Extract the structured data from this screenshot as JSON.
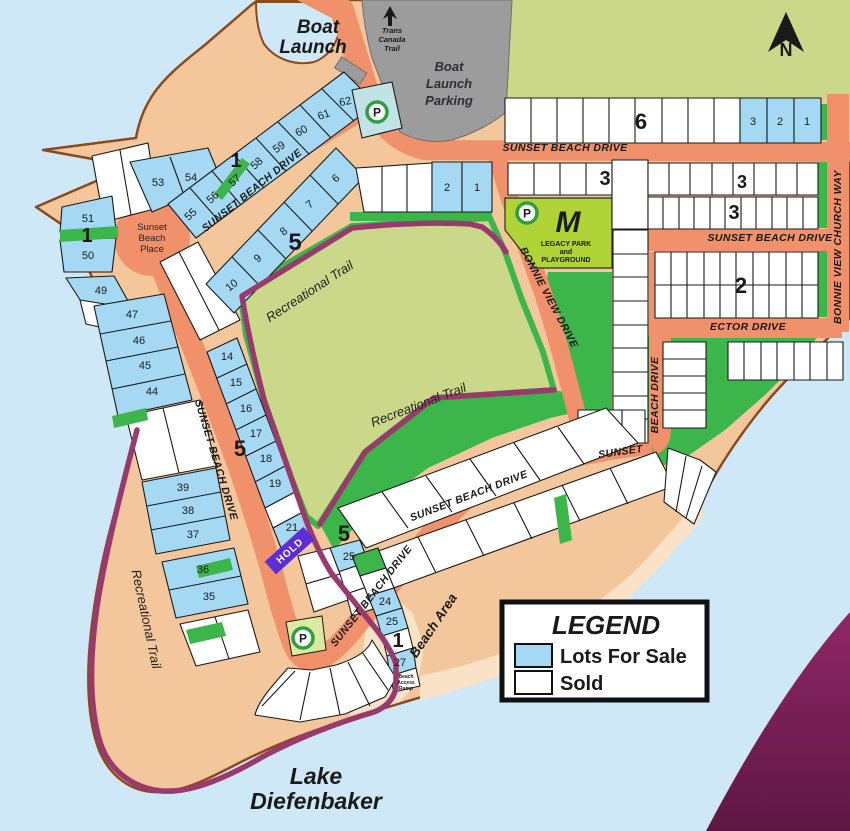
{
  "colors": {
    "water": "#cfe8f7",
    "land": "#f3c79b",
    "coast": "#8a4a1e",
    "beach": "#fae2c6",
    "olive": "#cbd88a",
    "green": "#3cb54a",
    "legacy": "#b0d437",
    "gray": "#9c9c9c",
    "road": "#f0916b",
    "forsale": "#a5d9f3",
    "sold": "#ffffff",
    "trail": "#993a6e",
    "deep_water_top": "#8f2766",
    "deep_water_bottom": "#5e1743",
    "hold_bg": "#5c2fd6"
  },
  "legend": {
    "title": "LEGEND",
    "items": [
      {
        "label": "Lots For Sale",
        "color": "#a5d9f3"
      },
      {
        "label": "Sold",
        "color": "#ffffff"
      }
    ]
  },
  "map": {
    "hold": "HOLD",
    "parking_letter": "P",
    "labels": [
      {
        "t": "SUNSET BEACH DRIVE",
        "x": 565,
        "y": 151,
        "r": 0,
        "c": "road"
      },
      {
        "t": "SUNSET BEACH DRIVE",
        "x": 770,
        "y": 241,
        "r": 0,
        "c": "road"
      },
      {
        "t": "ECTOR DRIVE",
        "x": 748,
        "y": 330,
        "r": 0,
        "c": "road"
      },
      {
        "t": "BONNIE VIEW CHURCH WAY",
        "x": 841,
        "y": 247,
        "r": -90,
        "c": "road"
      },
      {
        "t": "BONNIE VIEW DRIVE",
        "x": 546,
        "y": 299,
        "r": 62,
        "c": "road"
      },
      {
        "t": "SUNSET BEACH DRIVE",
        "x": 254,
        "y": 193,
        "r": -39,
        "c": "road"
      },
      {
        "t": "SUNSET BEACH DRIVE",
        "x": 213,
        "y": 461,
        "r": 73,
        "c": "road"
      },
      {
        "t": "SUNSET BEACH DRIVE",
        "x": 374,
        "y": 598,
        "r": -52,
        "c": "road"
      },
      {
        "t": "SUNSET BEACH DRIVE",
        "x": 470,
        "y": 499,
        "r": -21,
        "c": "road"
      },
      {
        "t": "SUNSET",
        "x": 621,
        "y": 455,
        "r": -8,
        "c": "road"
      },
      {
        "t": "BEACH DRIVE",
        "x": 658,
        "y": 395,
        "r": -90,
        "c": "road"
      },
      {
        "t": "Recreational Trail",
        "x": 312,
        "y": 295,
        "r": -33,
        "c": "trail"
      },
      {
        "t": "Recreational Trail",
        "x": 420,
        "y": 409,
        "r": -21,
        "c": "trail"
      },
      {
        "t": "Recreational Trail",
        "x": 142,
        "y": 620,
        "r": 78,
        "c": "trail"
      },
      {
        "t": "Beach Area",
        "x": 437,
        "y": 628,
        "r": -56,
        "c": "area"
      },
      {
        "t": "Lake",
        "x": 316,
        "y": 784,
        "r": 0,
        "c": "lake"
      },
      {
        "t": "Diefenbaker",
        "x": 316,
        "y": 809,
        "r": 0,
        "c": "lake"
      },
      {
        "t": "Boat",
        "x": 318,
        "y": 33,
        "r": 0,
        "c": "big"
      },
      {
        "t": "Launch",
        "x": 313,
        "y": 53,
        "r": 0,
        "c": "big"
      },
      {
        "t": "Boat",
        "x": 449,
        "y": 71,
        "r": 0,
        "c": "gray"
      },
      {
        "t": "Launch",
        "x": 449,
        "y": 88,
        "r": 0,
        "c": "gray"
      },
      {
        "t": "Parking",
        "x": 449,
        "y": 105,
        "r": 0,
        "c": "gray"
      },
      {
        "t": "Trans",
        "x": 392,
        "y": 33,
        "r": 0,
        "c": "tiny"
      },
      {
        "t": "Canada",
        "x": 392,
        "y": 42,
        "r": 0,
        "c": "tiny"
      },
      {
        "t": "Trail",
        "x": 392,
        "y": 51,
        "r": 0,
        "c": "tiny"
      },
      {
        "t": "Sunset",
        "x": 152,
        "y": 230,
        "r": 0,
        "c": "place"
      },
      {
        "t": "Beach",
        "x": 152,
        "y": 241,
        "r": 0,
        "c": "place"
      },
      {
        "t": "Place",
        "x": 152,
        "y": 252,
        "r": 0,
        "c": "place"
      },
      {
        "t": "M",
        "x": 568,
        "y": 232,
        "r": 0,
        "c": "m"
      },
      {
        "t": "LEGACY PARK",
        "x": 566,
        "y": 246,
        "r": 0,
        "c": "park-sm"
      },
      {
        "t": "and",
        "x": 566,
        "y": 254,
        "r": 0,
        "c": "park-sm"
      },
      {
        "t": "PLAYGROUND",
        "x": 566,
        "y": 262,
        "r": 0,
        "c": "park-sm"
      },
      {
        "t": "N",
        "x": 786,
        "y": 56,
        "r": 0,
        "c": "north"
      },
      {
        "t": "Beach",
        "x": 406,
        "y": 678,
        "r": 0,
        "c": "micro"
      },
      {
        "t": "Access",
        "x": 406,
        "y": 684,
        "r": 0,
        "c": "micro"
      },
      {
        "t": "Ramp",
        "x": 406,
        "y": 690,
        "r": 0,
        "c": "micro"
      }
    ],
    "lots": [
      {
        "n": "53",
        "x": 158,
        "y": 186,
        "r": 0
      },
      {
        "n": "54",
        "x": 191,
        "y": 181,
        "r": 0
      },
      {
        "n": "51",
        "x": 88,
        "y": 222,
        "r": 0
      },
      {
        "n": "50",
        "x": 88,
        "y": 259,
        "r": 0
      },
      {
        "n": "49",
        "x": 101,
        "y": 294,
        "r": 0
      },
      {
        "n": "55",
        "x": 193,
        "y": 217,
        "r": -42
      },
      {
        "n": "56",
        "x": 215,
        "y": 200,
        "r": -42
      },
      {
        "n": "57",
        "x": 237,
        "y": 183,
        "r": -42
      },
      {
        "n": "58",
        "x": 259,
        "y": 166,
        "r": -42
      },
      {
        "n": "59",
        "x": 281,
        "y": 150,
        "r": -35
      },
      {
        "n": "60",
        "x": 303,
        "y": 134,
        "r": -28
      },
      {
        "n": "61",
        "x": 325,
        "y": 118,
        "r": -20
      },
      {
        "n": "62",
        "x": 346,
        "y": 105,
        "r": -12
      },
      {
        "n": "10",
        "x": 234,
        "y": 288,
        "r": -40
      },
      {
        "n": "9",
        "x": 260,
        "y": 261,
        "r": -40
      },
      {
        "n": "8",
        "x": 286,
        "y": 234,
        "r": -40
      },
      {
        "n": "7",
        "x": 312,
        "y": 207,
        "r": -40
      },
      {
        "n": "6",
        "x": 338,
        "y": 181,
        "r": -40
      },
      {
        "n": "2",
        "x": 447,
        "y": 191,
        "r": 0
      },
      {
        "n": "1",
        "x": 477,
        "y": 191,
        "r": 0
      },
      {
        "n": "14",
        "x": 227,
        "y": 360,
        "r": 0
      },
      {
        "n": "15",
        "x": 236,
        "y": 386,
        "r": 0
      },
      {
        "n": "16",
        "x": 246,
        "y": 412,
        "r": 0
      },
      {
        "n": "17",
        "x": 256,
        "y": 437,
        "r": 0
      },
      {
        "n": "18",
        "x": 266,
        "y": 462,
        "r": 0
      },
      {
        "n": "19",
        "x": 275,
        "y": 487,
        "r": 0
      },
      {
        "n": "21",
        "x": 292,
        "y": 531,
        "r": 0
      },
      {
        "n": "47",
        "x": 132,
        "y": 318,
        "r": 0
      },
      {
        "n": "46",
        "x": 139,
        "y": 344,
        "r": 0
      },
      {
        "n": "45",
        "x": 145,
        "y": 369,
        "r": 0
      },
      {
        "n": "44",
        "x": 152,
        "y": 395,
        "r": 0
      },
      {
        "n": "39",
        "x": 183,
        "y": 491,
        "r": 0
      },
      {
        "n": "38",
        "x": 188,
        "y": 514,
        "r": 0
      },
      {
        "n": "37",
        "x": 193,
        "y": 538,
        "r": 0
      },
      {
        "n": "36",
        "x": 203,
        "y": 573,
        "r": 0
      },
      {
        "n": "35",
        "x": 209,
        "y": 600,
        "r": 0
      },
      {
        "n": "25",
        "x": 349,
        "y": 560,
        "r": 0
      },
      {
        "n": "24",
        "x": 385,
        "y": 605,
        "r": 0
      },
      {
        "n": "25",
        "x": 392,
        "y": 625,
        "r": 0
      },
      {
        "n": "27",
        "x": 400,
        "y": 666,
        "r": 0
      },
      {
        "n": "3",
        "x": 753,
        "y": 125,
        "r": 0
      },
      {
        "n": "2",
        "x": 780,
        "y": 125,
        "r": 0
      },
      {
        "n": "1",
        "x": 807,
        "y": 125,
        "r": 0
      }
    ],
    "blocks": [
      {
        "n": "1",
        "x": 236,
        "y": 167,
        "s": 20
      },
      {
        "n": "1",
        "x": 87,
        "y": 242,
        "s": 20
      },
      {
        "n": "5",
        "x": 295,
        "y": 250,
        "s": 24
      },
      {
        "n": "5",
        "x": 240,
        "y": 456,
        "s": 22
      },
      {
        "n": "5",
        "x": 344,
        "y": 541,
        "s": 22
      },
      {
        "n": "1",
        "x": 398,
        "y": 647,
        "s": 20
      },
      {
        "n": "6",
        "x": 641,
        "y": 129,
        "s": 22
      },
      {
        "n": "3",
        "x": 605,
        "y": 185,
        "s": 20
      },
      {
        "n": "3",
        "x": 734,
        "y": 219,
        "s": 20
      },
      {
        "n": "3",
        "x": 742,
        "y": 188,
        "s": 18,
        "f": "#b5b56f"
      },
      {
        "n": "2",
        "x": 741,
        "y": 293,
        "s": 22
      }
    ],
    "parking": [
      {
        "x": 377,
        "y": 112
      },
      {
        "x": 527,
        "y": 213
      },
      {
        "x": 303,
        "y": 638
      }
    ]
  }
}
